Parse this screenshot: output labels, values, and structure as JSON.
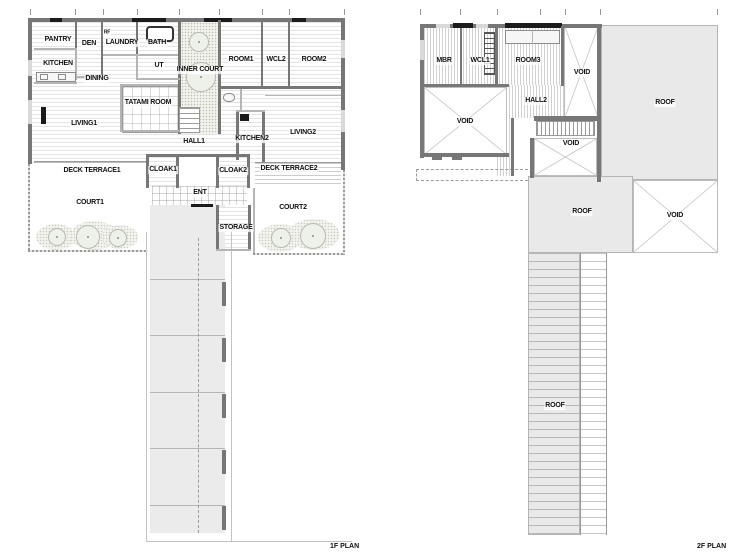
{
  "titles": {
    "floor1": "1F PLAN",
    "floor2": "2F PLAN"
  },
  "floor1": {
    "rooms": {
      "pantry": "PANTRY",
      "den": "DEN",
      "rf": "RF",
      "laundry": "LAUNDRY",
      "bath": "BATH",
      "kitchen": "KITCHEN",
      "ut": "UT",
      "inner_court": "INNER COURT",
      "dining": "DINING",
      "tatami": "TATAMI ROOM",
      "living1": "LIVING1",
      "hall1": "HALL1",
      "kitchen2": "KITCHEN2",
      "living2": "LIVING2",
      "room1": "ROOM1",
      "wcl2": "WCL2",
      "room2": "ROOM2",
      "deck_terrace1": "DECK TERRACE1",
      "cloak1": "CLOAK1",
      "cloak2": "CLOAK2",
      "deck_terrace2": "DECK TERRACE2",
      "ent": "ENT",
      "storage": "STORAGE",
      "court1": "COURT1",
      "court2": "COURT2"
    }
  },
  "floor2": {
    "rooms": {
      "mbr": "MBR",
      "wcl1": "WCL1",
      "room3": "ROOM3",
      "hall2": "HALL2",
      "void_right": "VOID",
      "void_left": "VOID",
      "void_center": "VOID",
      "void_se": "VOID",
      "roof_main": "ROOF",
      "roof_center": "ROOF",
      "roof_walk": "ROOF"
    }
  },
  "colors": {
    "wall": "#777777",
    "accent": "#1b1b1b",
    "roof_fill": "#e9e9e9"
  }
}
